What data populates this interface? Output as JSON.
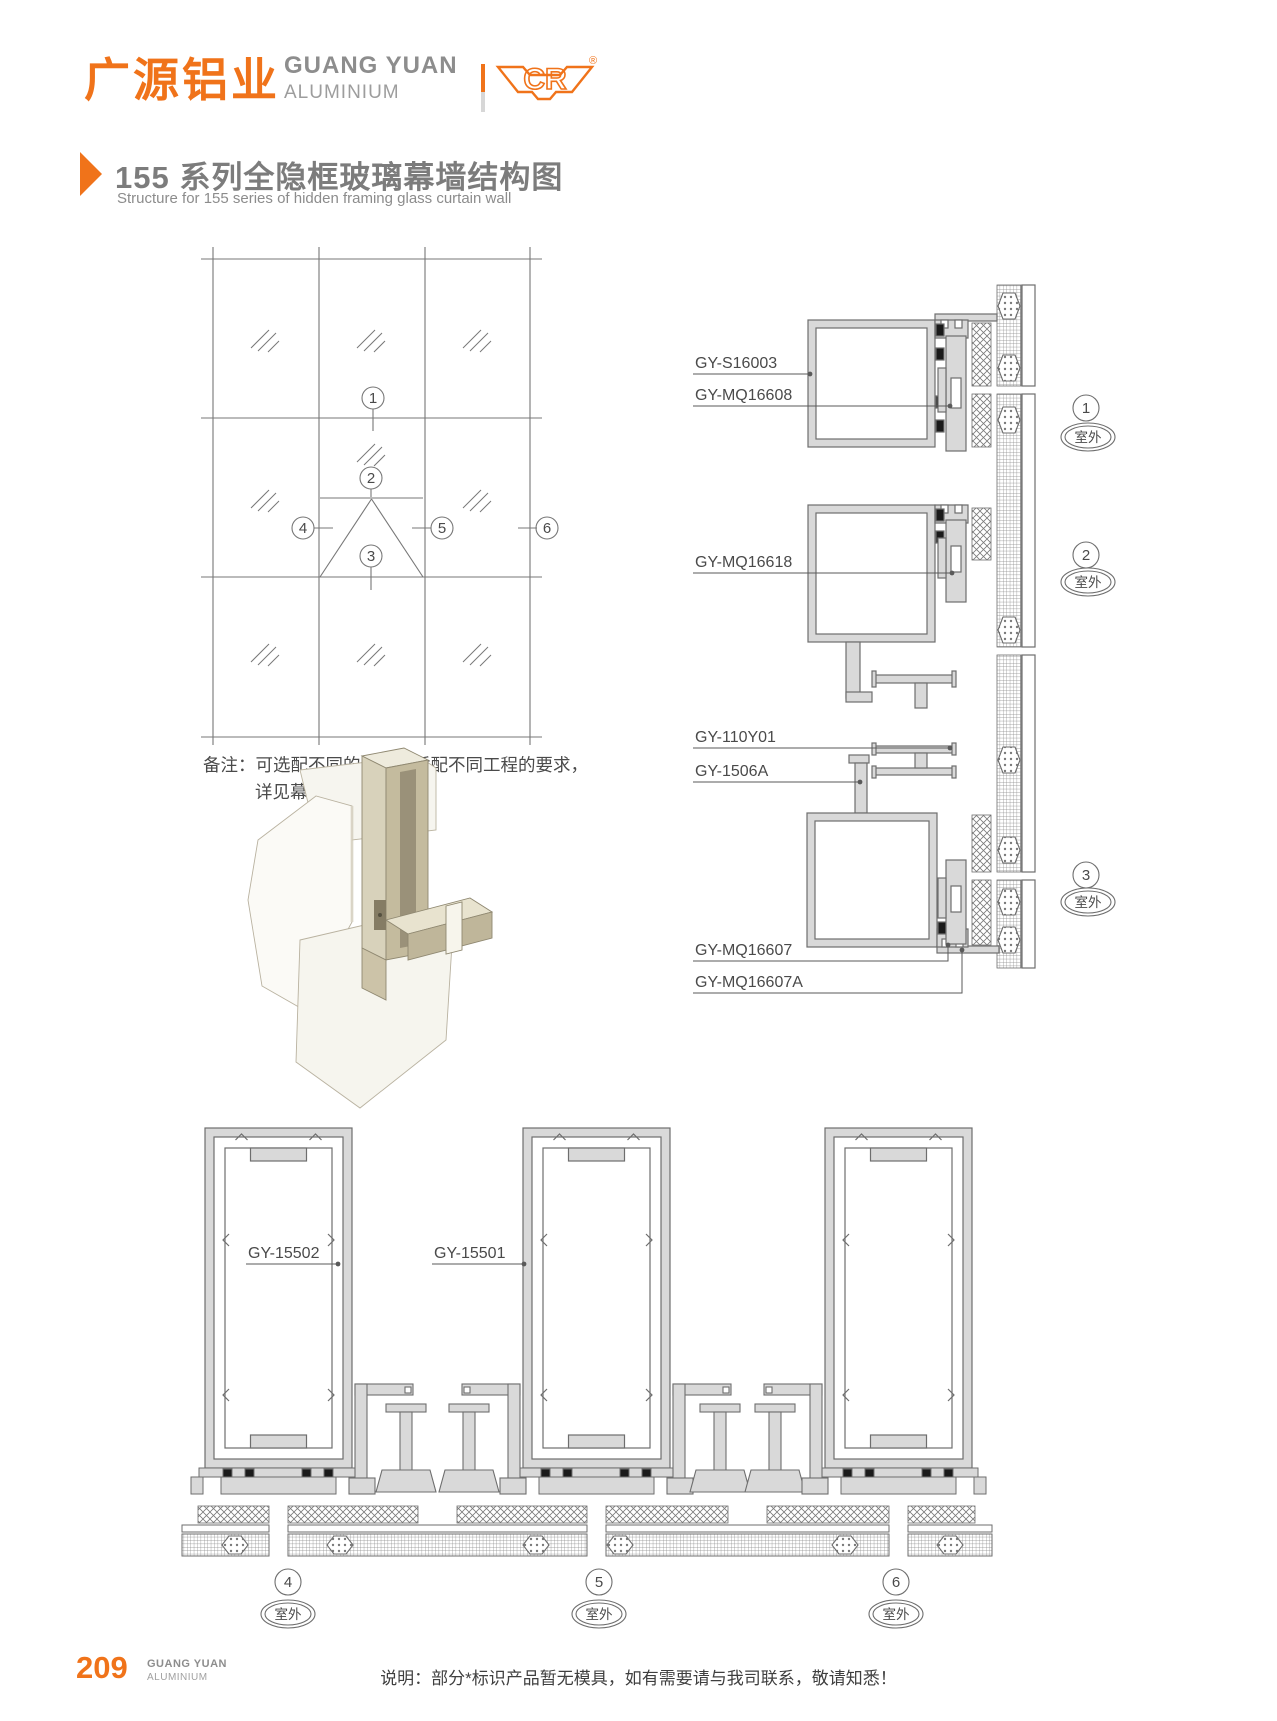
{
  "brand": {
    "cn": "广源铝业",
    "en_top": "GUANG YUAN",
    "en_bottom": "ALUMINIUM",
    "logo_letters": "CR",
    "registered": "®"
  },
  "title": {
    "zh": "155 系列全隐框玻璃幕墙结构图",
    "en": "Structure for 155 series of hidden framing glass curtain wall"
  },
  "note": {
    "line1": "备注：可选配不同的立柱以适配不同工程的要求，",
    "line2": "详见幕墙立柱汇总。"
  },
  "vertical_labels": [
    "GY-S16003",
    "GY-MQ16608",
    "GY-MQ16618",
    "GY-110Y01",
    "GY-1506A",
    "GY-MQ16607",
    "GY-MQ16607A"
  ],
  "plan_labels": [
    "GY-15502",
    "GY-15501"
  ],
  "callouts": [
    {
      "num": "1",
      "loc": "室外"
    },
    {
      "num": "2",
      "loc": "室外"
    },
    {
      "num": "3",
      "loc": "室外"
    },
    {
      "num": "4",
      "loc": "室外"
    },
    {
      "num": "5",
      "loc": "室外"
    },
    {
      "num": "6",
      "loc": "室外"
    }
  ],
  "footer": {
    "page": "209",
    "brand_top": "GUANG YUAN",
    "brand_bottom": "ALUMINIUM",
    "note": "说明：部分*标识产品暂无模具，如有需要请与我司联系，敬请知悉！"
  },
  "colors": {
    "accent_orange": "#f0731a",
    "text_gray": "#8a8a8a",
    "drawing_line": "#6e6e6e",
    "aluminium_fill": "#d9d9d9",
    "gasket_black": "#1a1a1a"
  }
}
